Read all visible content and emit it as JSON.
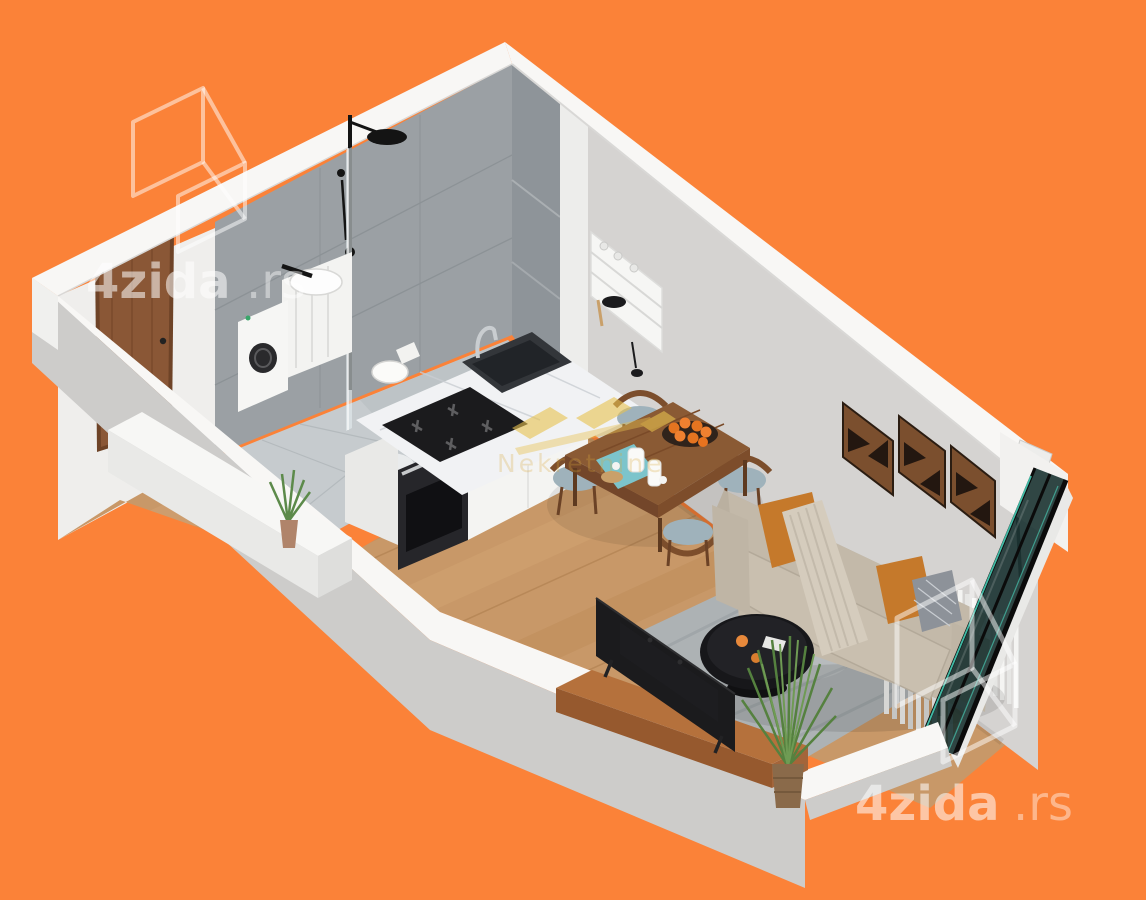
{
  "image": {
    "type": "isometric-3d-floor-plan-render",
    "subject": "studio apartment cutaway render on orange background",
    "canvas": {
      "width": 1146,
      "height": 900
    }
  },
  "colors": {
    "background": "#FB8238",
    "wall_top": "#F8F7F5",
    "wall_outer": "#CDCCCA",
    "wall_inner": "#EFEEEC",
    "living_wall": "#D5D3D1",
    "bath_tile": "#9BA0A4",
    "bath_tile_dark": "#8E9499",
    "bath_floor": "#C6CBCE",
    "floor_wood": "#C89868",
    "floor_wood_dark": "#BD8B58",
    "floor_wood_light": "#D2A372",
    "marble": "#F1F2F4",
    "cabinet_white": "#F4F4F2",
    "appliance_black": "#1B1B1D",
    "sofa": "#C3B9A9",
    "pillow_orange": "#C5792B",
    "rug": "#ADB2B4",
    "table_wood": "#8A5A34",
    "chair_wood": "#7C4E2C",
    "seat_cushion": "#9FB2BB",
    "door_wood": "#8A5736",
    "window_glass": "#142E2C",
    "glass_teal_edge": "#4BD9C0",
    "gold": "#E8C24F",
    "art_wood": "#7B4F2E",
    "plant_green": "#5C8A4A",
    "watermark_white": "#FFFFFF"
  },
  "watermarks": {
    "top_left": {
      "logo": "4zida-overlapping-walls-logo",
      "text_main": "4zida",
      "text_suffix": ".rs"
    },
    "bottom_right": {
      "logo": "4zida-overlapping-walls-logo",
      "text_main": "4zida",
      "text_suffix": ".rs"
    },
    "center": {
      "logo": "gold-agency-logo",
      "text": "Nekretnine"
    }
  },
  "scene": {
    "rooms": [
      "bathroom",
      "entry-hall",
      "kitchen",
      "dining-area",
      "living-area"
    ],
    "objects": [
      "entrance-door",
      "shower",
      "shower-glass-partition",
      "washbasin-vanity",
      "washing-machine",
      "toilet",
      "wall-shelf-rack",
      "kitchen-counter",
      "cooktop",
      "built-in-oven",
      "kitchen-sink",
      "faucet",
      "dining-table",
      "dining-chairs",
      "fruit-bowl",
      "tea-set",
      "sofa",
      "throw-pillows",
      "throw-blanket",
      "wall-art-panels",
      "coffee-table",
      "area-rug",
      "tv",
      "tv-bench",
      "floor-plant",
      "entry-plant",
      "shoe-bench",
      "radiator",
      "curtains",
      "floor-lamp",
      "window-wall"
    ]
  }
}
